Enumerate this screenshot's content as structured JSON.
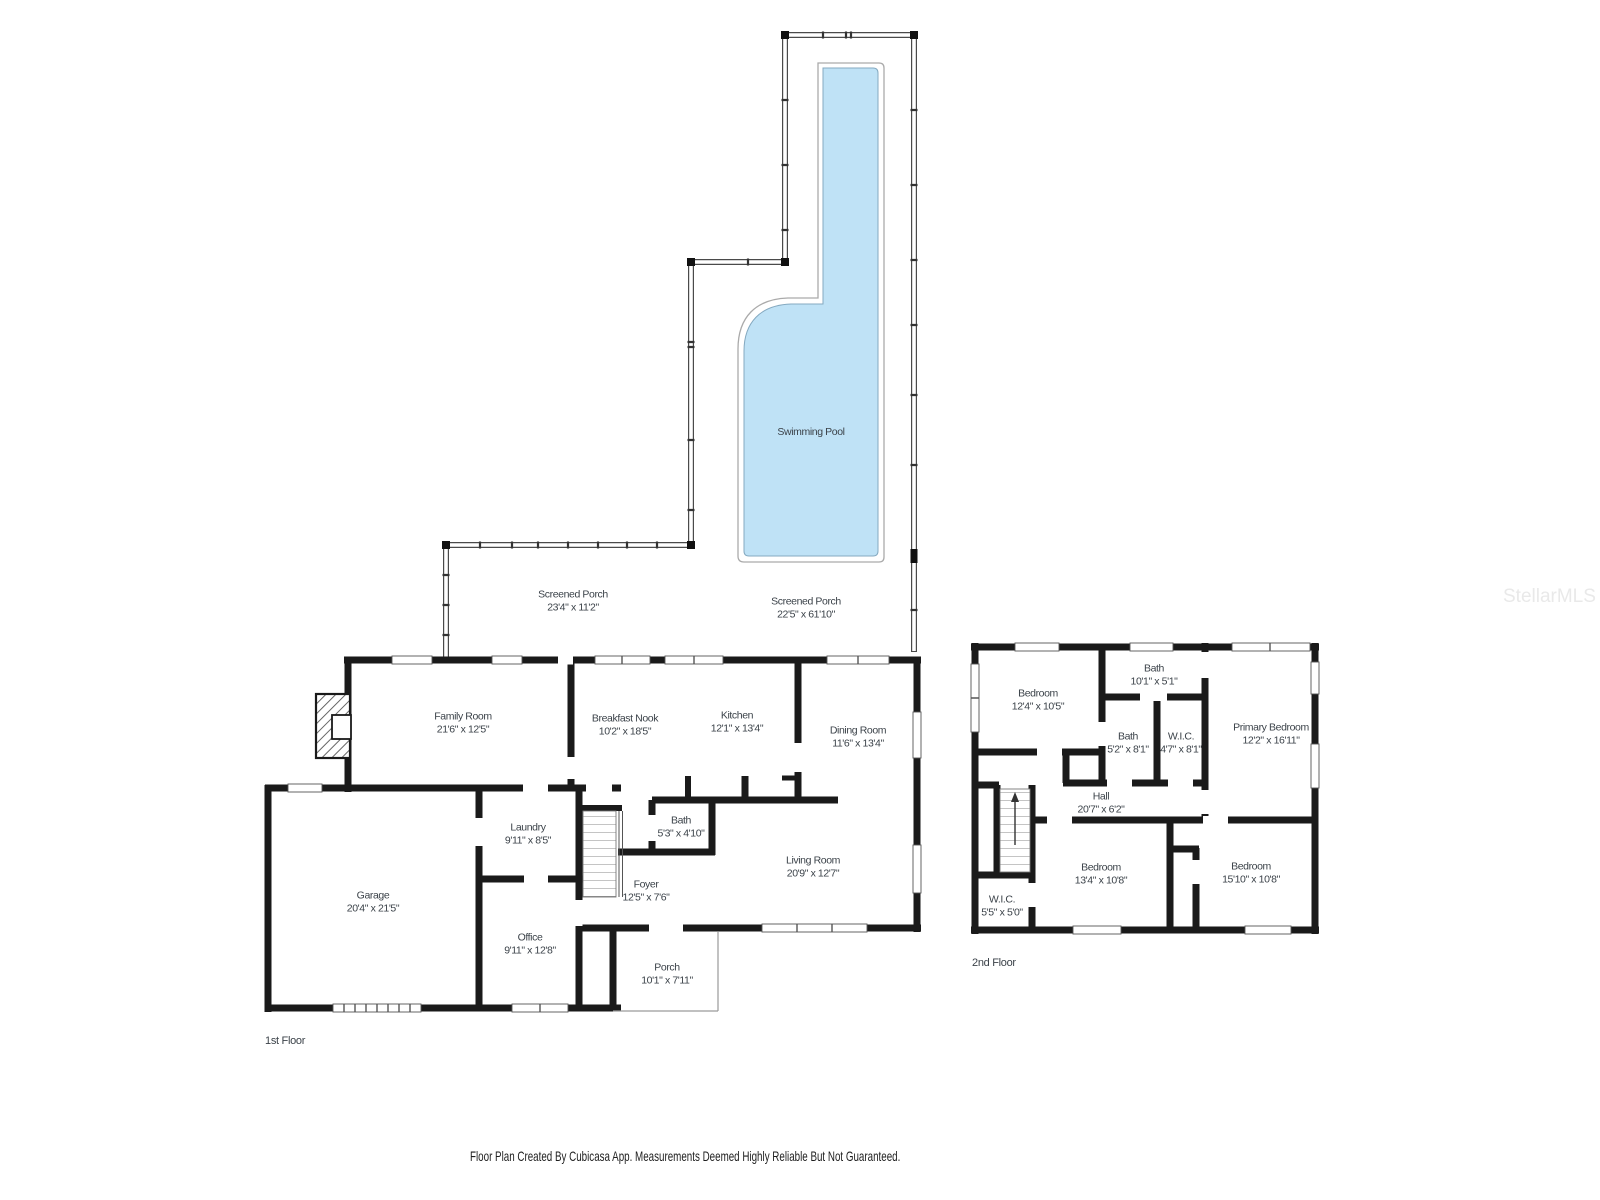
{
  "watermark": "StellarMLS",
  "footer_text": "Floor Plan Created By Cubicasa App. Measurements Deemed Highly Reliable But Not Guaranteed.",
  "pool_label": "Swimming Pool",
  "colors": {
    "pool_fill": "#bfe2f6",
    "wall": "#1a1a1a"
  },
  "floors": [
    {
      "label": "1st Floor",
      "rooms": [
        {
          "name": "Screened Porch",
          "dims": "23'4\" x 11'2\""
        },
        {
          "name": "Screened Porch",
          "dims": "22'5\" x 61'10\""
        },
        {
          "name": "Family Room",
          "dims": "21'6\" x 12'5\""
        },
        {
          "name": "Breakfast Nook",
          "dims": "10'2\" x 18'5\""
        },
        {
          "name": "Kitchen",
          "dims": "12'1\" x 13'4\""
        },
        {
          "name": "Dining Room",
          "dims": "11'6\" x 13'4\""
        },
        {
          "name": "Garage",
          "dims": "20'4\" x 21'5\""
        },
        {
          "name": "Laundry",
          "dims": "9'11\" x 8'5\""
        },
        {
          "name": "Office",
          "dims": "9'11\" x 12'8\""
        },
        {
          "name": "Bath",
          "dims": "5'3\" x 4'10\""
        },
        {
          "name": "Foyer",
          "dims": "12'5\" x 7'6\""
        },
        {
          "name": "Living Room",
          "dims": "20'9\" x 12'7\""
        },
        {
          "name": "Porch",
          "dims": "10'1\" x 7'11\""
        }
      ]
    },
    {
      "label": "2nd Floor",
      "rooms": [
        {
          "name": "Bedroom",
          "dims": "12'4\" x 10'5\""
        },
        {
          "name": "Bath",
          "dims": "10'1\" x 5'1\""
        },
        {
          "name": "Bath",
          "dims": "5'2\" x 8'1\""
        },
        {
          "name": "W.I.C.",
          "dims": "4'7\" x 8'1\""
        },
        {
          "name": "Primary Bedroom",
          "dims": "12'2\" x 16'11\""
        },
        {
          "name": "Hall",
          "dims": "20'7\" x 6'2\""
        },
        {
          "name": "Bedroom",
          "dims": "13'4\" x 10'8\""
        },
        {
          "name": "Bedroom",
          "dims": "15'10\" x 10'8\""
        },
        {
          "name": "W.I.C.",
          "dims": "5'5\" x 5'0\""
        }
      ]
    }
  ]
}
